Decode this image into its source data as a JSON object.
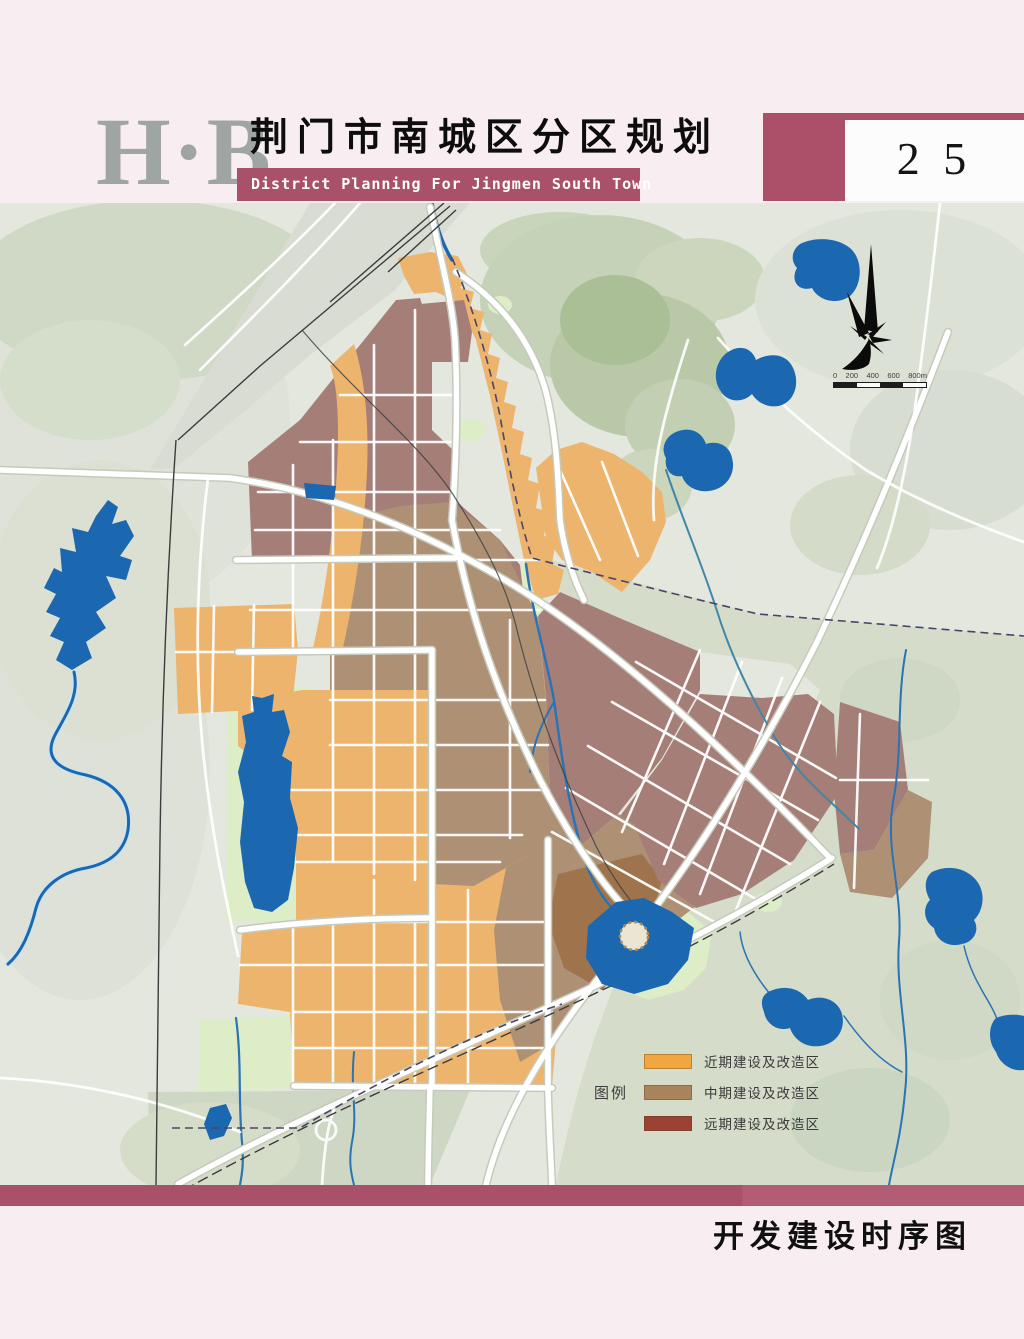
{
  "header": {
    "logo": "H·B",
    "title_cn": "荆门市南城区分区规划",
    "title_en": "District Planning For Jingmen South Town",
    "page_number": "2 5"
  },
  "map": {
    "legend": {
      "title": "图例",
      "items": [
        {
          "label": "近期建设及改造区",
          "color": "#f0a73f"
        },
        {
          "label": "中期建设及改造区",
          "color": "#a9845a"
        },
        {
          "label": "远期建设及改造区",
          "color": "#9c4136"
        }
      ]
    },
    "scale_bar": {
      "labels": [
        "0",
        "200",
        "400",
        "600",
        "800m"
      ]
    }
  },
  "footer": {
    "caption": "开发建设时序图"
  },
  "colors": {
    "accent_maroon": "#a85168",
    "water_blue": "#1b67b0",
    "near_term_orange": "#ecb46d",
    "mid_term_brown": "#ae9175",
    "long_term_mauve": "#a67e78"
  }
}
